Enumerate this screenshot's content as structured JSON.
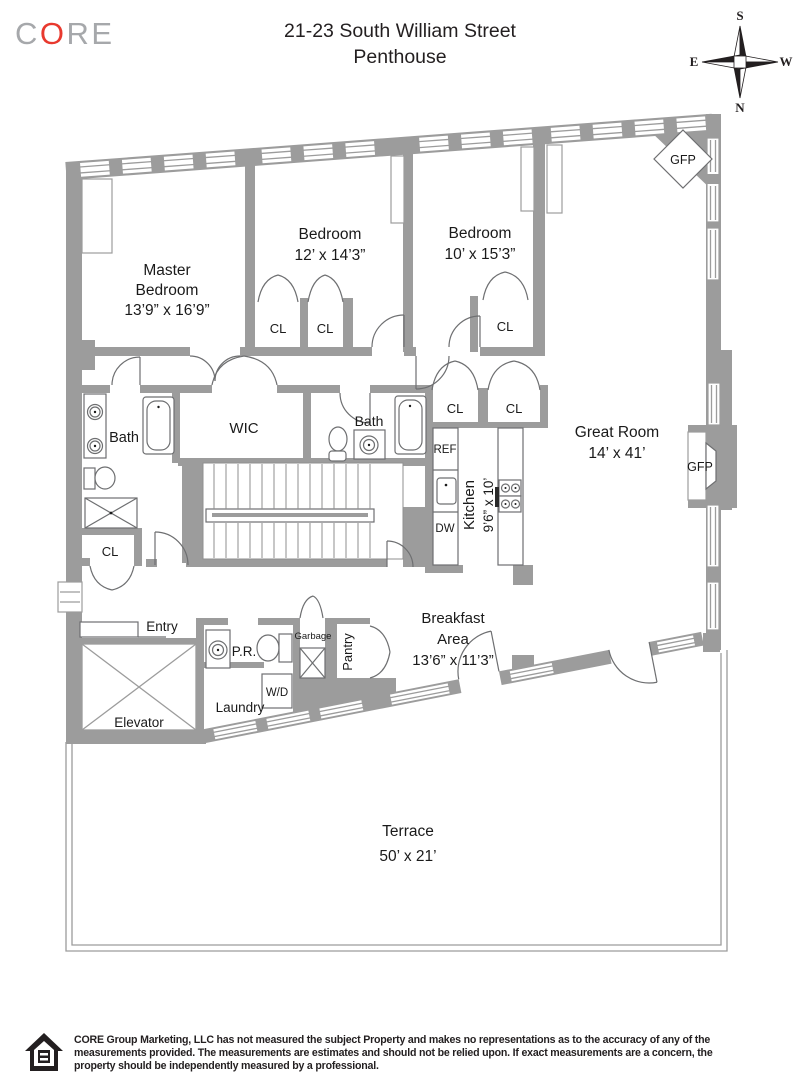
{
  "header": {
    "logo_c": "C",
    "logo_o": "O",
    "logo_re": "RE",
    "title_line1": "21-23 South William Street",
    "title_line2": "Penthouse"
  },
  "compass": {
    "top": "S",
    "bottom": "N",
    "left": "E",
    "right": "W"
  },
  "plan_labels": {
    "master_1": "Master",
    "master_2": "Bedroom",
    "master_3": "13’9” x 16’9”",
    "bedroom2_1": "Bedroom",
    "bedroom2_2": "12’ x 14’3”",
    "bedroom3_1": "Bedroom",
    "bedroom3_2": "10’ x 15’3”",
    "great_room_1": "Great Room",
    "great_room_2": "14’ x 41’",
    "kitchen_1": "Kitchen",
    "kitchen_2": "9’6” x 10’",
    "breakfast_1": "Breakfast",
    "breakfast_2": "Area",
    "breakfast_3": "13’6” x 11’3”",
    "terrace_1": "Terrace",
    "terrace_2": "50’ x 21’",
    "bath": "Bath",
    "wic": "WIC",
    "cl": "CL",
    "entry": "Entry",
    "elevator": "Elevator",
    "pr": "P.R.",
    "laundry": "Laundry",
    "wd": "W/D",
    "garbage": "Garbage",
    "pantry": "Pantry",
    "ref": "REF",
    "dw": "DW",
    "gfp": "GFP"
  },
  "colors": {
    "wall_gray": "#9c9c9c",
    "fixture_stroke": "#6e6f71",
    "text": "#1a1a1a",
    "logo_gray": "#a6a8ab",
    "logo_red": "#e8392e"
  },
  "footer": {
    "line1": "CORE Group Marketing, LLC has not measured the subject Property and makes no representations as to the accuracy of any of the",
    "line2": "measurements provided. The measurements are estimates and should not be relied upon. If exact measurements are a concern, the",
    "line3": "property should be independently measured by a professional."
  }
}
